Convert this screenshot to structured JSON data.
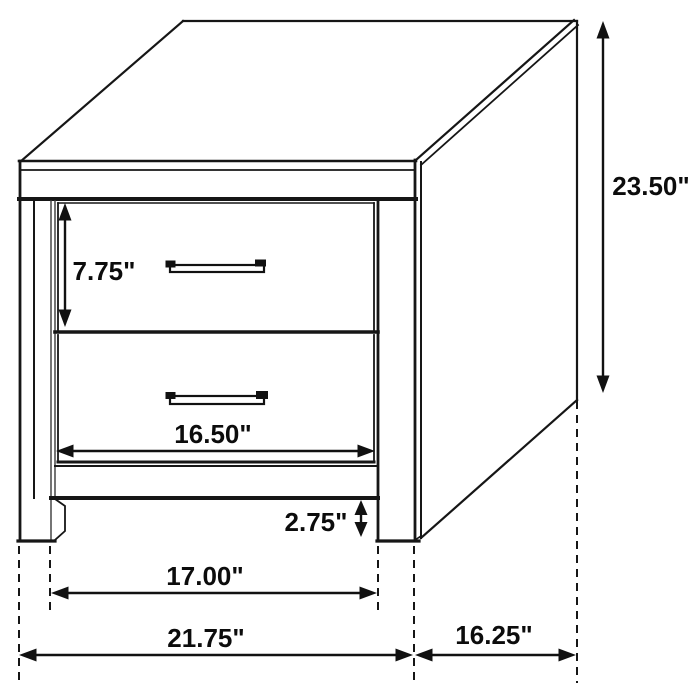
{
  "figure": {
    "alt": "Two-drawer nightstand line drawing with dimension arrows",
    "background": "#ffffff",
    "line_color": "#161616",
    "text_color": "#0c0c0c"
  },
  "dimensions": {
    "overall_height": "23.50\"",
    "drawer_height": "7.75\"",
    "drawer_opening_width": "16.50\"",
    "leg_height": "2.75\"",
    "between_legs_width": "17.00\"",
    "overall_width": "21.75\"",
    "overall_depth": "16.25\""
  }
}
